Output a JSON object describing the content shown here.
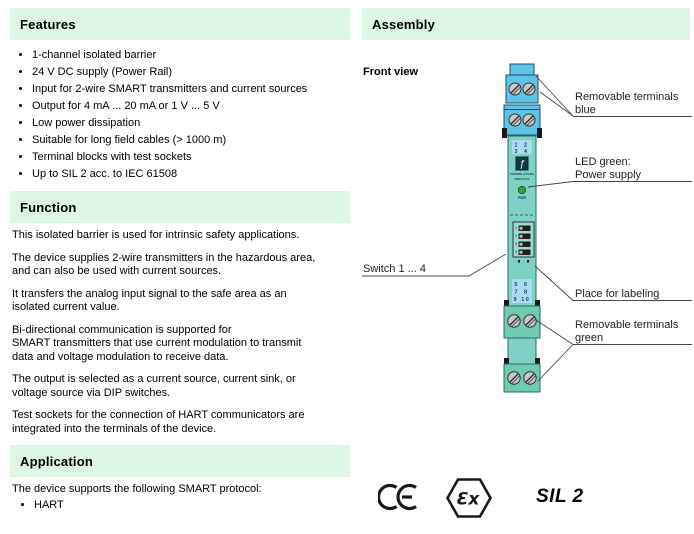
{
  "colors": {
    "header_bg": "#ddf5e3",
    "device_teal": "#7fd0c5",
    "device_blue": "#5ec3e6",
    "device_green": "#6fcbb1",
    "label_blue": "#a9dcf0",
    "number_navy": "#16406e",
    "led_green": "#2fa63c"
  },
  "left": {
    "features": {
      "title": "Features",
      "items": [
        "1-channel isolated barrier",
        "24 V DC supply (Power Rail)",
        "Input for 2-wire SMART transmitters and current sources",
        "Output for 4 mA ... 20 mA or 1 V ... 5 V",
        "Low power dissipation",
        "Suitable for long field cables (> 1000 m)",
        "Terminal blocks with test sockets",
        "Up to SIL 2 acc. to IEC 61508"
      ]
    },
    "function": {
      "title": "Function",
      "paragraphs": [
        "This isolated barrier is used for intrinsic safety applications.",
        "The device supplies 2-wire transmitters in the hazardous area,\nand can also be used with current sources.",
        "It transfers the analog input signal to the safe area as an\nisolated current value.",
        "Bi-directional communication is supported for\nSMART transmitters that use current modulation to transmit\ndata and voltage modulation to receive data.",
        "The output is selected as a current source, current sink, or\nvoltage source via DIP switches.",
        "Test sockets for the connection of HART communicators are\nintegrated into the terminals of the device."
      ]
    },
    "application": {
      "title": "Application",
      "intro": "The device supports the following SMART protocol:",
      "items": [
        "HART"
      ]
    }
  },
  "right": {
    "assembly_title": "Assembly",
    "front_view": "Front view",
    "device": {
      "top_terminals_row1": "1 2",
      "top_terminals_row2": "3 4",
      "bottom_terminals_row1": "5 6",
      "bottom_terminals_row2": "7 8",
      "bottom_terminals_row3": "9 10",
      "brand": "PEPPERL+FUCHS",
      "model": "KFD2-STC4",
      "logo_glyph": "ƒ",
      "led_label": "PWR",
      "dip_numbers": [
        "1",
        "2",
        "3",
        "4"
      ]
    },
    "callouts": {
      "terminals_blue_line1": "Removable terminals",
      "terminals_blue_line2": "blue",
      "led_line1": "LED green:",
      "led_line2": "Power supply",
      "switches": "Switch 1 ... 4",
      "labeling": "Place for labeling",
      "terminals_green_line1": "Removable terminals",
      "terminals_green_line2": "green"
    },
    "marks": {
      "ce": "CE",
      "ex": "Ɛx",
      "sil": "SIL 2"
    }
  }
}
